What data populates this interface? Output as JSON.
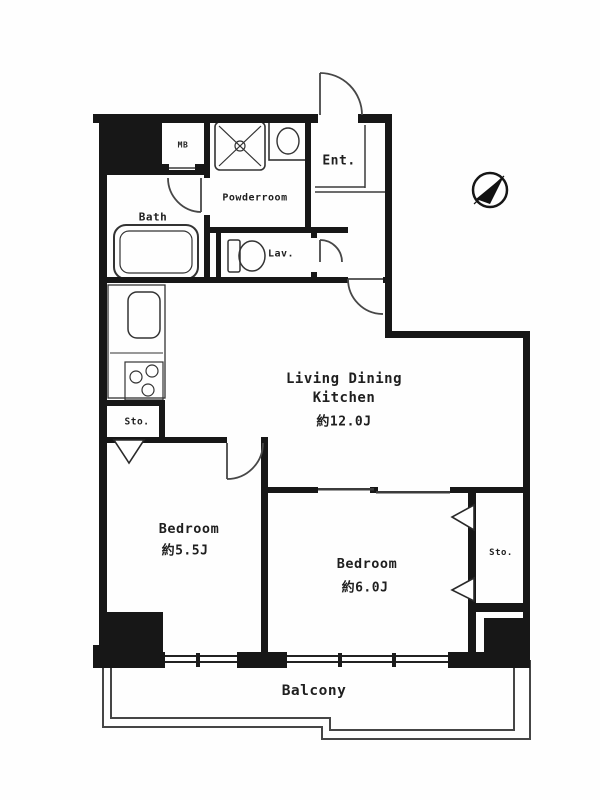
{
  "document": {
    "kind": "apartment-floor-plan",
    "orientation_mark": "compass-needle-pointing-northeast"
  },
  "colors": {
    "background": "#ffffff",
    "wall": "#171717",
    "line": "#3b3b3b",
    "text": "#1f1f1f"
  },
  "rooms": {
    "ldk": {
      "name_line1": "Living Dining",
      "name_line2": "Kitchen",
      "area": "約12.0J"
    },
    "bedroom_left": {
      "name": "Bedroom",
      "area": "約5.5J"
    },
    "bedroom_right": {
      "name": "Bedroom",
      "area": "約6.0J"
    },
    "bath": {
      "name": "Bath"
    },
    "powder_room": {
      "name": "Powderroom"
    },
    "lavatory": {
      "name": "Lav."
    },
    "entrance": {
      "name": "Ent."
    },
    "meter_box": {
      "name": "MB"
    },
    "storage_left": {
      "name": "Sto."
    },
    "storage_right": {
      "name": "Sto."
    },
    "balcony": {
      "name": "Balcony"
    }
  },
  "fixtures": {
    "bathtub": "bathtub-icon",
    "toilet": "toilet-icon",
    "washer_pan": "washer-pan-icon",
    "washbasin": "washbasin-icon",
    "kitchen_sink": "kitchen-sink-icon",
    "stove": "stove-burners-icon",
    "compass": "compass-icon"
  }
}
